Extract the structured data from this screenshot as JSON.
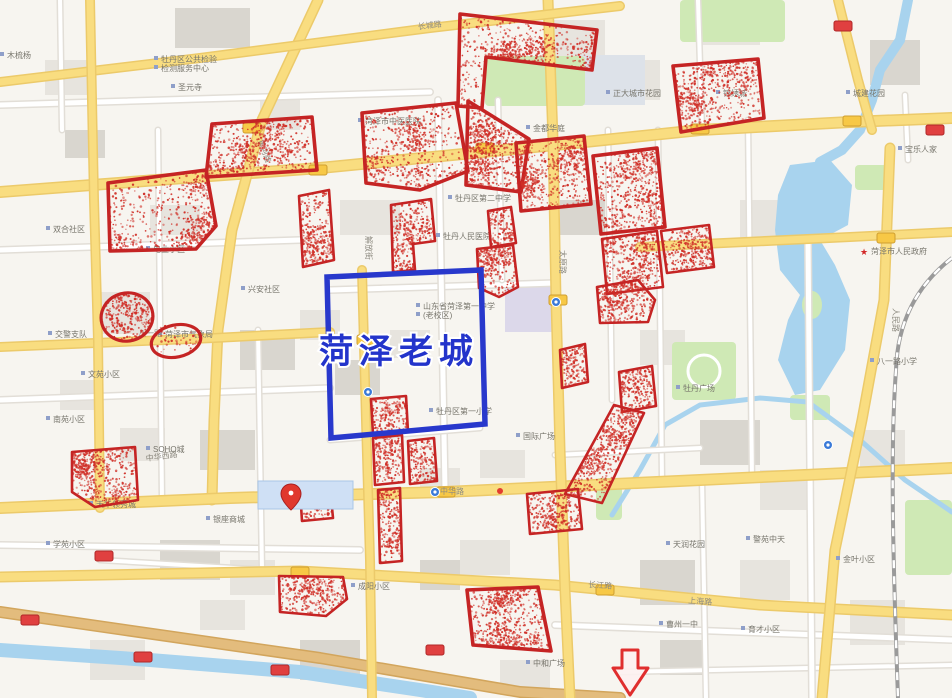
{
  "map": {
    "title_overlay": "菏泽老城",
    "description": "web map of Heze city with red-dotted analysis zones",
    "colors": {
      "background": "#f7f5f0",
      "building": "#e7e4de",
      "building_dark": "#d9d6cf",
      "campus": "#dde2e9",
      "mall": "#dcd8ea",
      "park": "#cfe9b5",
      "water": "#a8d3ee",
      "road_major": "#f9dd80",
      "road_major_casing": "#ecca6a",
      "road_minor": "#ffffff",
      "road_minor_casing": "#e2ded7",
      "road_tan": "#e3bc7d",
      "road_tan_casing": "#d2a55c",
      "zone_stroke": "#c52424",
      "zone_dot": "#d03028",
      "old_city_stroke": "#2838cc",
      "arrow_stroke": "#e02e2e",
      "pin_fill": "#e0382e",
      "badge_red": "#e04040",
      "badge_yellow": "#f7c846"
    }
  },
  "annotations": {
    "old_city_box": {
      "label": "菏泽老城",
      "label_color": "#2334cb",
      "label_pos": [
        399,
        363
      ],
      "points": [
        [
          327,
          277
        ],
        [
          481,
          270
        ],
        [
          485,
          424
        ],
        [
          331,
          438
        ]
      ]
    },
    "zones": [
      {
        "points": [
          [
            460,
            14
          ],
          [
            597,
            30
          ],
          [
            592,
            70
          ],
          [
            486,
            57
          ],
          [
            482,
            108
          ],
          [
            458,
            106
          ]
        ]
      },
      {
        "points": [
          [
            673,
            66
          ],
          [
            758,
            59
          ],
          [
            764,
            118
          ],
          [
            681,
            132
          ]
        ]
      },
      {
        "points": [
          [
            212,
            124
          ],
          [
            312,
            117
          ],
          [
            317,
            170
          ],
          [
            206,
            177
          ]
        ]
      },
      {
        "points": [
          [
            108,
            183
          ],
          [
            206,
            170
          ],
          [
            216,
            226
          ],
          [
            196,
            249
          ],
          [
            110,
            251
          ]
        ]
      },
      {
        "points": [
          [
            299,
            196
          ],
          [
            329,
            190
          ],
          [
            334,
            260
          ],
          [
            303,
            267
          ]
        ]
      },
      {
        "points": [
          [
            362,
            113
          ],
          [
            456,
            103
          ],
          [
            468,
            171
          ],
          [
            420,
            190
          ],
          [
            366,
            183
          ]
        ]
      },
      {
        "points": [
          [
            468,
            101
          ],
          [
            529,
            139
          ],
          [
            521,
            192
          ],
          [
            466,
            185
          ]
        ]
      },
      {
        "points": [
          [
            391,
            205
          ],
          [
            431,
            199
          ],
          [
            435,
            241
          ],
          [
            413,
            244
          ],
          [
            415,
            270
          ],
          [
            393,
            272
          ]
        ]
      },
      {
        "points": [
          [
            488,
            211
          ],
          [
            511,
            207
          ],
          [
            516,
            243
          ],
          [
            491,
            247
          ]
        ]
      },
      {
        "points": [
          [
            477,
            249
          ],
          [
            513,
            245
          ],
          [
            518,
            287
          ],
          [
            499,
            297
          ],
          [
            479,
            288
          ]
        ]
      },
      {
        "points": [
          [
            516,
            143
          ],
          [
            584,
            136
          ],
          [
            591,
            204
          ],
          [
            521,
            211
          ]
        ]
      },
      {
        "points": [
          [
            593,
            156
          ],
          [
            657,
            148
          ],
          [
            665,
            227
          ],
          [
            601,
            234
          ]
        ]
      },
      {
        "points": [
          [
            602,
            239
          ],
          [
            657,
            231
          ],
          [
            663,
            287
          ],
          [
            607,
            294
          ]
        ]
      },
      {
        "points": [
          [
            661,
            231
          ],
          [
            709,
            225
          ],
          [
            714,
            267
          ],
          [
            667,
            273
          ]
        ]
      },
      {
        "points": [
          [
            597,
            287
          ],
          [
            638,
            280
          ],
          [
            655,
            300
          ],
          [
            648,
            322
          ],
          [
            600,
            323
          ]
        ]
      },
      {
        "points": [
          [
            560,
            350
          ],
          [
            585,
            344
          ],
          [
            588,
            382
          ],
          [
            562,
            388
          ]
        ]
      },
      {
        "points": [
          [
            619,
            372
          ],
          [
            652,
            366
          ],
          [
            656,
            406
          ],
          [
            622,
            412
          ]
        ]
      },
      {
        "points": [
          [
            614,
            405
          ],
          [
            644,
            413
          ],
          [
            602,
            503
          ],
          [
            565,
            494
          ]
        ]
      },
      {
        "points": [
          [
            371,
            399
          ],
          [
            406,
            396
          ],
          [
            408,
            432
          ],
          [
            373,
            435
          ]
        ]
      },
      {
        "points": [
          [
            373,
            438
          ],
          [
            402,
            435
          ],
          [
            404,
            482
          ],
          [
            375,
            485
          ]
        ]
      },
      {
        "points": [
          [
            408,
            441
          ],
          [
            434,
            438
          ],
          [
            437,
            481
          ],
          [
            410,
            484
          ]
        ]
      },
      {
        "points": [
          [
            378,
            490
          ],
          [
            400,
            488
          ],
          [
            402,
            561
          ],
          [
            380,
            563
          ]
        ]
      },
      {
        "points": [
          [
            300,
            490
          ],
          [
            330,
            487
          ],
          [
            333,
            518
          ],
          [
            302,
            521
          ]
        ]
      },
      {
        "points": [
          [
            72,
            452
          ],
          [
            135,
            447
          ],
          [
            138,
            500
          ],
          [
            95,
            507
          ],
          [
            72,
            492
          ]
        ]
      },
      {
        "points": [
          [
            279,
            576
          ],
          [
            343,
            577
          ],
          [
            347,
            599
          ],
          [
            326,
            616
          ],
          [
            280,
            612
          ]
        ]
      },
      {
        "points": [
          [
            467,
            590
          ],
          [
            538,
            587
          ],
          [
            551,
            651
          ],
          [
            473,
            645
          ]
        ]
      },
      {
        "points": [
          [
            527,
            494
          ],
          [
            578,
            489
          ],
          [
            582,
            529
          ],
          [
            530,
            534
          ]
        ]
      }
    ],
    "ellipses": [
      {
        "cx": 127,
        "cy": 317,
        "rx": 26,
        "ry": 24,
        "rot": -15,
        "density": 1.0
      },
      {
        "cx": 176,
        "cy": 341,
        "rx": 25,
        "ry": 16,
        "rot": -12,
        "density": 0.25
      }
    ],
    "arrow": {
      "points": [
        [
          622,
          650
        ],
        [
          638,
          650
        ],
        [
          638,
          668
        ],
        [
          648,
          668
        ],
        [
          630,
          695
        ],
        [
          613,
          668
        ],
        [
          622,
          668
        ]
      ]
    },
    "pin": {
      "x": 291,
      "y": 497,
      "label": "亿联时代广场",
      "highlight": [
        258,
        481,
        95,
        28
      ]
    }
  },
  "road_labels": [
    {
      "x": 452,
      "y": 494,
      "text": "中华路",
      "rot": 0
    },
    {
      "x": 162,
      "y": 459,
      "text": "中华西路",
      "rot": -8
    },
    {
      "x": 600,
      "y": 588,
      "text": "长江路",
      "rot": 4
    },
    {
      "x": 700,
      "y": 604,
      "text": "上海路",
      "rot": 4
    },
    {
      "x": 893,
      "y": 320,
      "text": "人民路",
      "rot": 90
    },
    {
      "x": 150,
      "y": 336,
      "text": "八一路",
      "rot": 0
    },
    {
      "x": 560,
      "y": 262,
      "text": "太原路",
      "rot": 90
    },
    {
      "x": 366,
      "y": 248,
      "text": "解放街",
      "rot": 90
    },
    {
      "x": 262,
      "y": 152,
      "text": "黄河路",
      "rot": 70
    },
    {
      "x": 430,
      "y": 28,
      "text": "长城路",
      "rot": -7
    }
  ],
  "map_labels": [
    {
      "x": 293,
      "y": 508,
      "text": "亿联时代广场",
      "color": "#3c78c8"
    },
    {
      "x": 450,
      "y": 239,
      "text": "牡丹人民医院"
    },
    {
      "x": 430,
      "y": 309,
      "text": "山东省菏泽第一中学"
    },
    {
      "x": 430,
      "y": 318,
      "text": "(老校区)"
    },
    {
      "x": 443,
      "y": 414,
      "text": "牡丹区第一小学"
    },
    {
      "x": 462,
      "y": 201,
      "text": "牡丹区第二中学"
    },
    {
      "x": 878,
      "y": 254,
      "text": "菏泽市人民政府",
      "icon": "star"
    },
    {
      "x": 884,
      "y": 364,
      "text": "八一路小学"
    },
    {
      "x": 690,
      "y": 391,
      "text": "牡丹广场",
      "color": "#6b8f5a"
    },
    {
      "x": 168,
      "y": 62,
      "text": "牡丹区公共检验"
    },
    {
      "x": 168,
      "y": 71,
      "text": "检测服务中心"
    },
    {
      "x": 185,
      "y": 90,
      "text": "圣元寺"
    },
    {
      "x": 14,
      "y": 58,
      "text": "木梳杨"
    },
    {
      "x": 372,
      "y": 124,
      "text": "菏泽市中医医院"
    },
    {
      "x": 540,
      "y": 131,
      "text": "金都华庭"
    },
    {
      "x": 620,
      "y": 96,
      "text": "正大城市花园"
    },
    {
      "x": 730,
      "y": 96,
      "text": "锦绣城"
    },
    {
      "x": 860,
      "y": 96,
      "text": "城建花园"
    },
    {
      "x": 912,
      "y": 152,
      "text": "宝乐人家"
    },
    {
      "x": 60,
      "y": 232,
      "text": "双合社区"
    },
    {
      "x": 160,
      "y": 252,
      "text": "电业小区"
    },
    {
      "x": 255,
      "y": 292,
      "text": "兴安社区"
    },
    {
      "x": 172,
      "y": 337,
      "text": "菏泽市气象局"
    },
    {
      "x": 62,
      "y": 337,
      "text": "交警支队"
    },
    {
      "x": 95,
      "y": 377,
      "text": "文苑小区"
    },
    {
      "x": 60,
      "y": 422,
      "text": "南苑小区"
    },
    {
      "x": 160,
      "y": 452,
      "text": "SOHO城"
    },
    {
      "x": 103,
      "y": 507,
      "text": "天华领秀城"
    },
    {
      "x": 60,
      "y": 547,
      "text": "学苑小区"
    },
    {
      "x": 220,
      "y": 522,
      "text": "银座商城"
    },
    {
      "x": 530,
      "y": 439,
      "text": "国际广场"
    },
    {
      "x": 680,
      "y": 547,
      "text": "天润花园"
    },
    {
      "x": 760,
      "y": 542,
      "text": "警苑中天"
    },
    {
      "x": 365,
      "y": 589,
      "text": "成阳小区"
    },
    {
      "x": 673,
      "y": 627,
      "text": "曹州一中"
    },
    {
      "x": 755,
      "y": 632,
      "text": "育才小区"
    },
    {
      "x": 850,
      "y": 562,
      "text": "金叶小区"
    },
    {
      "x": 540,
      "y": 666,
      "text": "中和广场"
    }
  ],
  "road_badges": [
    {
      "x": 843,
      "y": 26,
      "type": "red"
    },
    {
      "x": 935,
      "y": 130,
      "type": "red"
    },
    {
      "x": 30,
      "y": 620,
      "type": "red"
    },
    {
      "x": 143,
      "y": 657,
      "type": "red"
    },
    {
      "x": 280,
      "y": 670,
      "type": "red"
    },
    {
      "x": 435,
      "y": 650,
      "type": "red"
    },
    {
      "x": 104,
      "y": 556,
      "type": "red"
    },
    {
      "x": 318,
      "y": 170,
      "type": "yellow"
    },
    {
      "x": 252,
      "y": 128,
      "type": "yellow"
    },
    {
      "x": 485,
      "y": 148,
      "type": "yellow"
    },
    {
      "x": 700,
      "y": 129,
      "type": "yellow"
    },
    {
      "x": 852,
      "y": 121,
      "type": "yellow"
    },
    {
      "x": 446,
      "y": 492,
      "type": "yellow"
    },
    {
      "x": 558,
      "y": 300,
      "type": "yellow"
    },
    {
      "x": 886,
      "y": 238,
      "type": "yellow"
    },
    {
      "x": 300,
      "y": 572,
      "type": "yellow"
    },
    {
      "x": 605,
      "y": 590,
      "type": "yellow"
    },
    {
      "x": 366,
      "y": 340,
      "type": "yellow"
    }
  ],
  "transit_icons": [
    {
      "x": 435,
      "y": 492
    },
    {
      "x": 556,
      "y": 302
    },
    {
      "x": 368,
      "y": 392
    },
    {
      "x": 828,
      "y": 445
    }
  ]
}
